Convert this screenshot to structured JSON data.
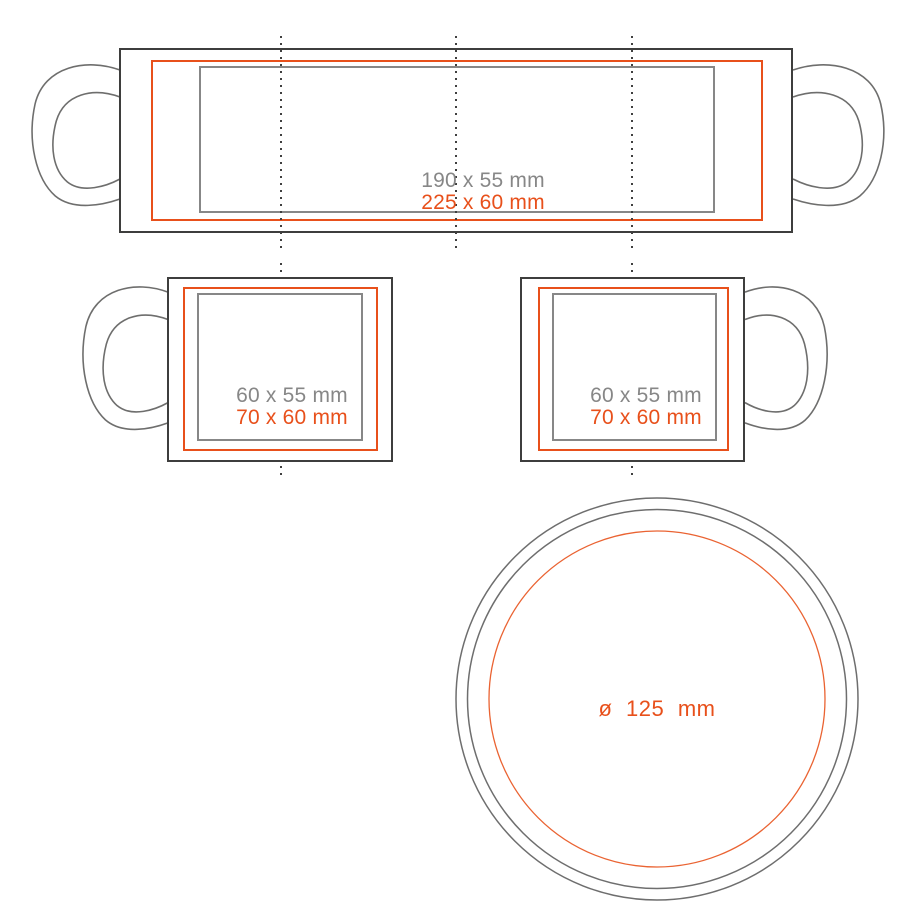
{
  "colors": {
    "accent_orange": "#e8501b",
    "dimension_gray": "#878787",
    "outline_dark": "#3e3e3d",
    "handle_gray": "#6e6e6d"
  },
  "views": {
    "wrap": {
      "standard_area_label": "190 x 55 mm",
      "max_area_label": "225 x 60 mm"
    },
    "left_side": {
      "standard_area_label": "60 x 55 mm",
      "max_area_label": "70 x 60 mm"
    },
    "right_side": {
      "standard_area_label": "60 x 55 mm",
      "max_area_label": "70 x 60 mm"
    },
    "bottom": {
      "diameter_label": "ø 125 mm"
    }
  }
}
